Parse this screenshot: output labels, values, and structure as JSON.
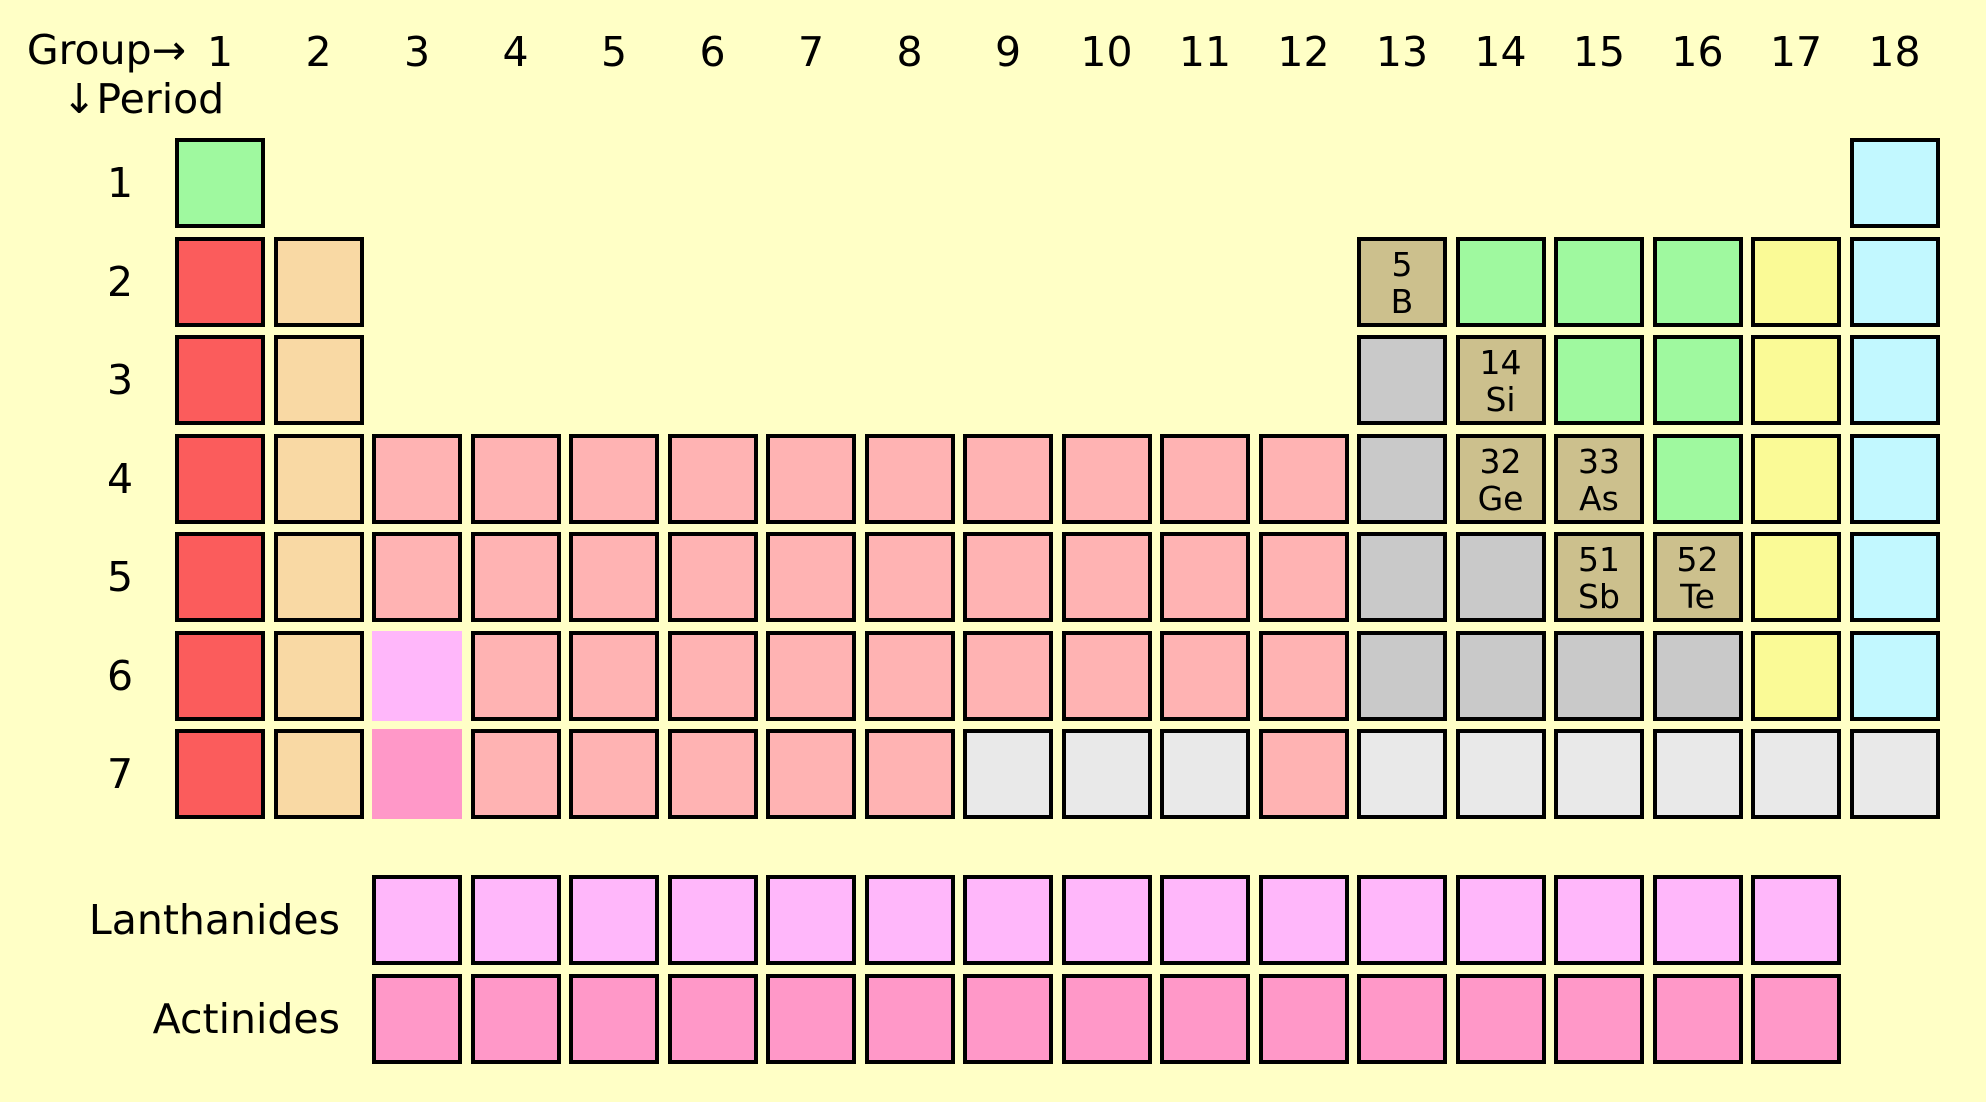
{
  "header": {
    "group_label": "Group",
    "group_arrow": "→",
    "period_arrow": "↓",
    "period_label": "Period",
    "columns": [
      "1",
      "2",
      "3",
      "4",
      "5",
      "6",
      "7",
      "8",
      "9",
      "10",
      "11",
      "12",
      "13",
      "14",
      "15",
      "16",
      "17",
      "18"
    ]
  },
  "periods": [
    {
      "label": "1",
      "cells": [
        {
          "from": 1,
          "cat": "nonmetal"
        },
        {
          "from": 18,
          "cat": "noble"
        }
      ]
    },
    {
      "label": "2",
      "cells": [
        {
          "from": 1,
          "cat": "alkali"
        },
        {
          "from": 2,
          "cat": "alkaline"
        },
        {
          "from": 13,
          "cat": "metalloid",
          "num": "5",
          "sym": "B"
        },
        {
          "from": 14,
          "to": 16,
          "cat": "nonmetal"
        },
        {
          "from": 17,
          "cat": "halogen"
        },
        {
          "from": 18,
          "cat": "noble"
        }
      ]
    },
    {
      "label": "3",
      "cells": [
        {
          "from": 1,
          "cat": "alkali"
        },
        {
          "from": 2,
          "cat": "alkaline"
        },
        {
          "from": 13,
          "cat": "post"
        },
        {
          "from": 14,
          "cat": "metalloid",
          "num": "14",
          "sym": "Si"
        },
        {
          "from": 15,
          "to": 16,
          "cat": "nonmetal"
        },
        {
          "from": 17,
          "cat": "halogen"
        },
        {
          "from": 18,
          "cat": "noble"
        }
      ]
    },
    {
      "label": "4",
      "cells": [
        {
          "from": 1,
          "cat": "alkali"
        },
        {
          "from": 2,
          "cat": "alkaline"
        },
        {
          "from": 3,
          "to": 12,
          "cat": "transition"
        },
        {
          "from": 13,
          "cat": "post"
        },
        {
          "from": 14,
          "cat": "metalloid",
          "num": "32",
          "sym": "Ge"
        },
        {
          "from": 15,
          "cat": "metalloid",
          "num": "33",
          "sym": "As"
        },
        {
          "from": 16,
          "cat": "nonmetal"
        },
        {
          "from": 17,
          "cat": "halogen"
        },
        {
          "from": 18,
          "cat": "noble"
        }
      ]
    },
    {
      "label": "5",
      "cells": [
        {
          "from": 1,
          "cat": "alkali"
        },
        {
          "from": 2,
          "cat": "alkaline"
        },
        {
          "from": 3,
          "to": 12,
          "cat": "transition"
        },
        {
          "from": 13,
          "to": 14,
          "cat": "post"
        },
        {
          "from": 15,
          "cat": "metalloid",
          "num": "51",
          "sym": "Sb"
        },
        {
          "from": 16,
          "cat": "metalloid",
          "num": "52",
          "sym": "Te"
        },
        {
          "from": 17,
          "cat": "halogen"
        },
        {
          "from": 18,
          "cat": "noble"
        }
      ]
    },
    {
      "label": "6",
      "cells": [
        {
          "from": 1,
          "cat": "alkali"
        },
        {
          "from": 2,
          "cat": "alkaline"
        },
        {
          "from": 3,
          "cat": "lanthanide",
          "frameless": true
        },
        {
          "from": 4,
          "to": 12,
          "cat": "transition"
        },
        {
          "from": 13,
          "to": 16,
          "cat": "post"
        },
        {
          "from": 17,
          "cat": "halogen"
        },
        {
          "from": 18,
          "cat": "noble"
        }
      ]
    },
    {
      "label": "7",
      "cells": [
        {
          "from": 1,
          "cat": "alkali"
        },
        {
          "from": 2,
          "cat": "alkaline"
        },
        {
          "from": 3,
          "cat": "actinide",
          "frameless": true
        },
        {
          "from": 4,
          "to": 8,
          "cat": "transition"
        },
        {
          "from": 9,
          "to": 11,
          "cat": "unknown"
        },
        {
          "from": 12,
          "cat": "transition"
        },
        {
          "from": 13,
          "to": 18,
          "cat": "unknown"
        }
      ]
    }
  ],
  "series_rows": [
    {
      "label": "Lanthanides",
      "cat": "lanthanide",
      "start_group": 3,
      "count": 15
    },
    {
      "label": "Actinides",
      "cat": "actinide",
      "start_group": 3,
      "count": 15
    }
  ],
  "palette": {
    "background": "#FFFFC6",
    "border": "#000000",
    "alkali": "#FB5C5C",
    "alkaline": "#F9D9A4",
    "transition": "#FFB3B3",
    "post": "#C9C9C9",
    "metalloid": "#CCC08D",
    "nonmetal": "#9FF99F",
    "halogen": "#FAFA96",
    "noble": "#C2F8FF",
    "unknown": "#E9E9E9",
    "lanthanide": "#FFB7FA",
    "actinide": "#FF98C8"
  }
}
